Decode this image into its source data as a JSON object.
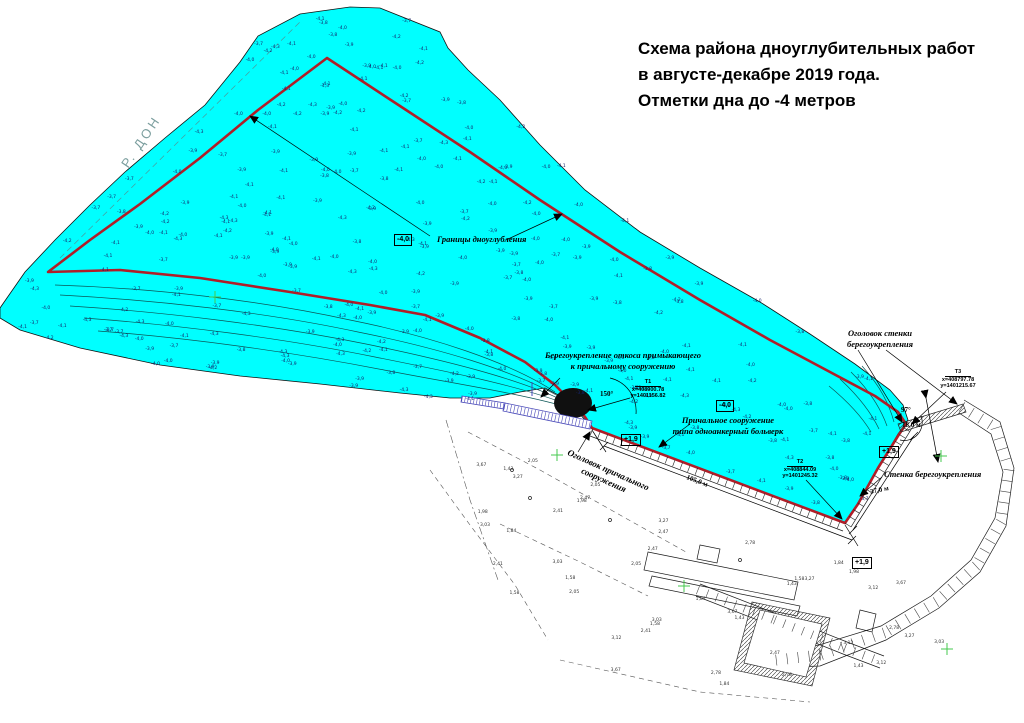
{
  "title": {
    "l1": "Схема района дноуглубительных работ",
    "l2": "в августе-декабре 2019 года.",
    "l3": "Отметки дна до -4 метров"
  },
  "river": {
    "name": "Р. ДОН"
  },
  "labels": {
    "boundary": "Границы дноуглубления",
    "slope_l1": "Берегоукрепление откоса примыкающего",
    "slope_l2": "к причальному сооружению",
    "berth_l1": "Причальное сооружение",
    "berth_l2": "типа одноанкерный больверк",
    "berth_head_l1": "Оголовок причального",
    "berth_head_l2": "сооружения",
    "wall_head_l1": "Оголовок стенки",
    "wall_head_l2": "берегоукрепления",
    "wall": "Стенка берегоукрепления"
  },
  "marks": {
    "depth": "-4,0",
    "crest": "+1,9"
  },
  "points": {
    "t1": {
      "name": "Т1",
      "x": "x=408900.78",
      "y": "y=1401156.82"
    },
    "t2": {
      "name": "Т2",
      "x": "x=408844.09",
      "y": "y=1401245.32"
    },
    "t3": {
      "name": "Т3",
      "x": "x=408797.78",
      "y": "y=1401215.67"
    }
  },
  "dimensions": {
    "quay": "105,0 м",
    "wall": "37,0 м",
    "wall_head": "18,0 м",
    "berth_angle": "150°",
    "wall_angle": "97°"
  },
  "soundings": {
    "water": [
      "-3,8",
      "-3,9",
      "-4,0",
      "-4,1",
      "-4,2",
      "-3,7",
      "-4,3",
      "-4,0",
      "-3,9",
      "-4,1"
    ],
    "land": [
      "1,58",
      "2,47",
      "3,03",
      "3,27",
      "1,84",
      "2,78",
      "3,67",
      "1,43",
      "3,12",
      "2,05",
      "1,98",
      "2,41"
    ]
  },
  "colors": {
    "water": "#00ffff",
    "boundary": "#b01e28",
    "contour": "#0b5555",
    "sounding": "#15246b",
    "cross": "#46c94f",
    "pier": "#4747b8",
    "river_text": "#7b9e9e"
  }
}
